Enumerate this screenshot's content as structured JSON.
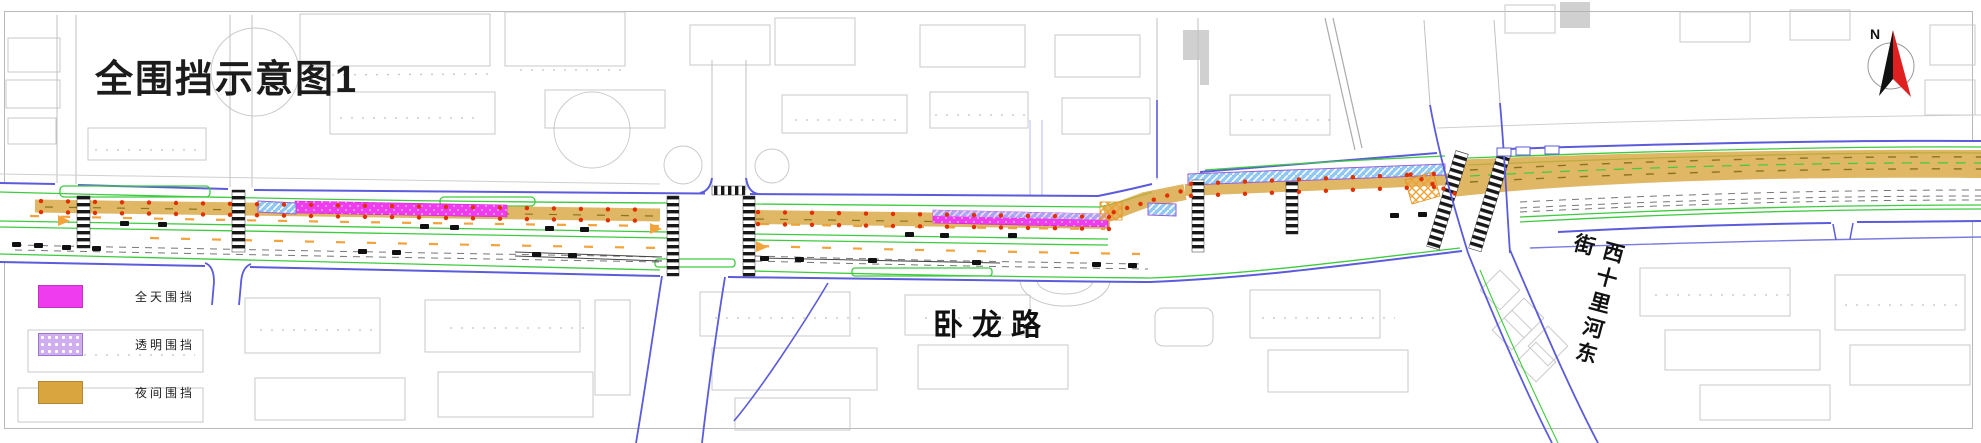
{
  "title": "全围挡示意图1",
  "legend": {
    "items": [
      {
        "label": "全天围挡",
        "color": "#ee3cee",
        "pattern": "solid"
      },
      {
        "label": "透明围挡",
        "color": "#cfaef0",
        "pattern": "dots"
      },
      {
        "label": "夜间围挡",
        "color": "#d8a53e",
        "pattern": "solid"
      }
    ]
  },
  "labels": {
    "main_road": "卧龙路",
    "cross_street": "西十里河东街",
    "compass_north": "N"
  },
  "colors": {
    "all_day": "#ee3cee",
    "transparent_hatch": "#8fc8f2",
    "transparent_border": "#9b5fd6",
    "night": "#d8a53e",
    "curb_blue": "#5b5bdc",
    "lane_green": "#3ecb3e",
    "marker_red": "#e03000",
    "accent_orange": "#f2a33c",
    "compass_red": "#e02020"
  }
}
